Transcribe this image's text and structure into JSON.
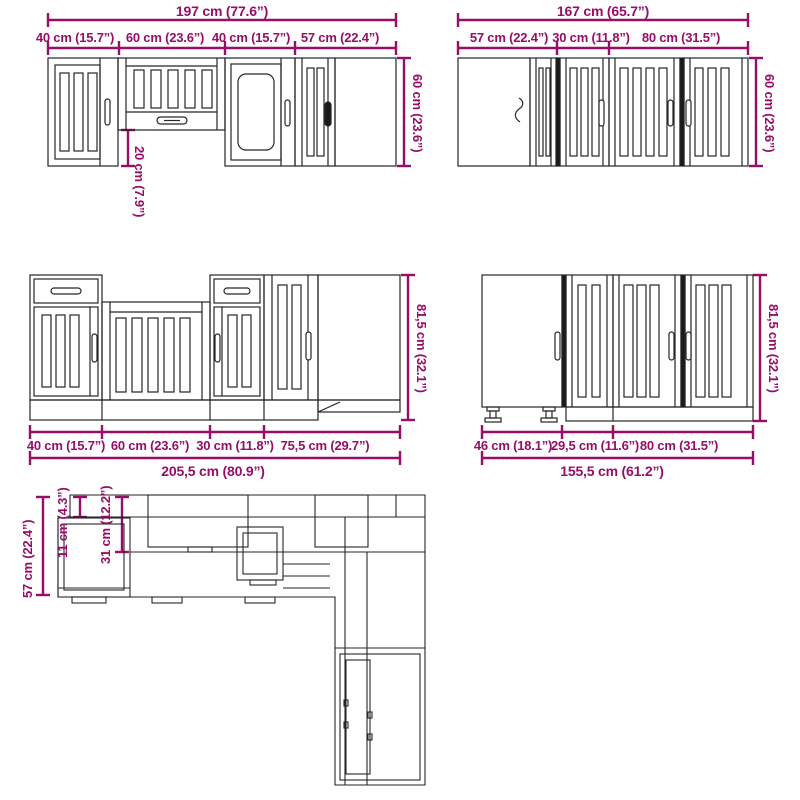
{
  "colors": {
    "dimension": "#970e68",
    "line": "#262626",
    "background": "#ffffff"
  },
  "groups": {
    "wall_left": {
      "total": "197 cm (77.6”)",
      "segments": [
        "40 cm (15.7”)",
        "60 cm (23.6”)",
        "40 cm (15.7”)",
        "57 cm (22.4”)"
      ],
      "height": "60 cm (23.6”)",
      "inner_height": "20 cm (7.9”)"
    },
    "wall_right": {
      "total": "167 cm (65.7”)",
      "segments": [
        "57 cm (22.4”)",
        "30 cm (11.8”)",
        "80 cm (31.5”)"
      ],
      "height": "60 cm (23.6”)"
    },
    "base_left": {
      "total": "205,5 cm (80.9”)",
      "segments": [
        "40 cm (15.7”)",
        "60 cm (23.6”)",
        "30 cm (11.8”)",
        "75,5 cm (29.7”)"
      ],
      "height": "81,5 cm (32.1”)"
    },
    "base_right": {
      "total": "155,5 cm (61.2”)",
      "segments": [
        "46 cm (18.1”)",
        "29,5 cm (11.6”)",
        "80 cm (31.5”)"
      ],
      "height": "81,5 cm (32.1”)"
    },
    "plan": {
      "depth": "57 cm (22.4”)",
      "dim_small": "11 cm (4.3”)",
      "dim_medium": "31 cm (12.2”)"
    }
  }
}
